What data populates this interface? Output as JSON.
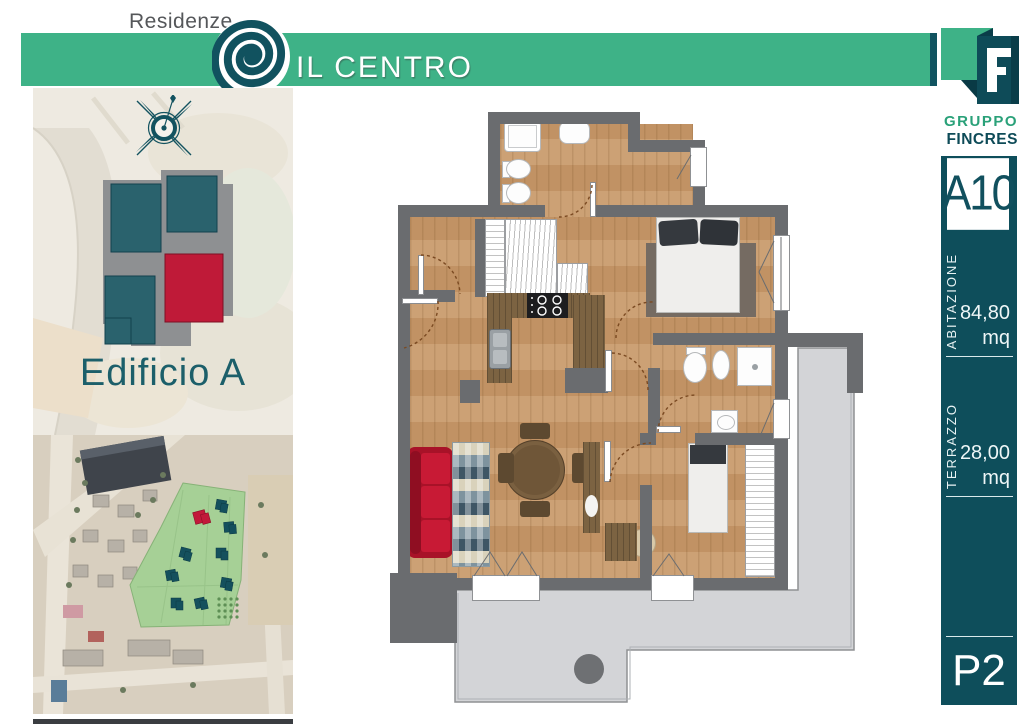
{
  "header": {
    "residenze_label": "Residenze",
    "project_name": "IL CENTRO",
    "accent_green": "#3eb287",
    "accent_teal": "#115360",
    "logo_icon": "spiral-logo"
  },
  "left_panel": {
    "building_label": "Edificio A",
    "compass_icon": "compass-rose",
    "site_plan_highlight_color": "#c2183a",
    "site_plan_building_color": "#2a626d"
  },
  "sidebar": {
    "company_name_line1": "GRUPPO",
    "company_name_line2": "FINCRES",
    "company_logo_icon": "fincres-f-logo",
    "unit_code": "A10",
    "areas": [
      {
        "label": "ABITAZIONE",
        "value": "84,80",
        "unit": "mq"
      },
      {
        "label": "TERRAZZO",
        "value": "28,00",
        "unit": "mq"
      }
    ],
    "floor_code": "P2",
    "bar_color": "#0e4e5b"
  },
  "plan": {
    "sofa_color": "#b5132d",
    "wall_color": "#6a6c6f",
    "terrace_color": "#d3d4d7"
  }
}
